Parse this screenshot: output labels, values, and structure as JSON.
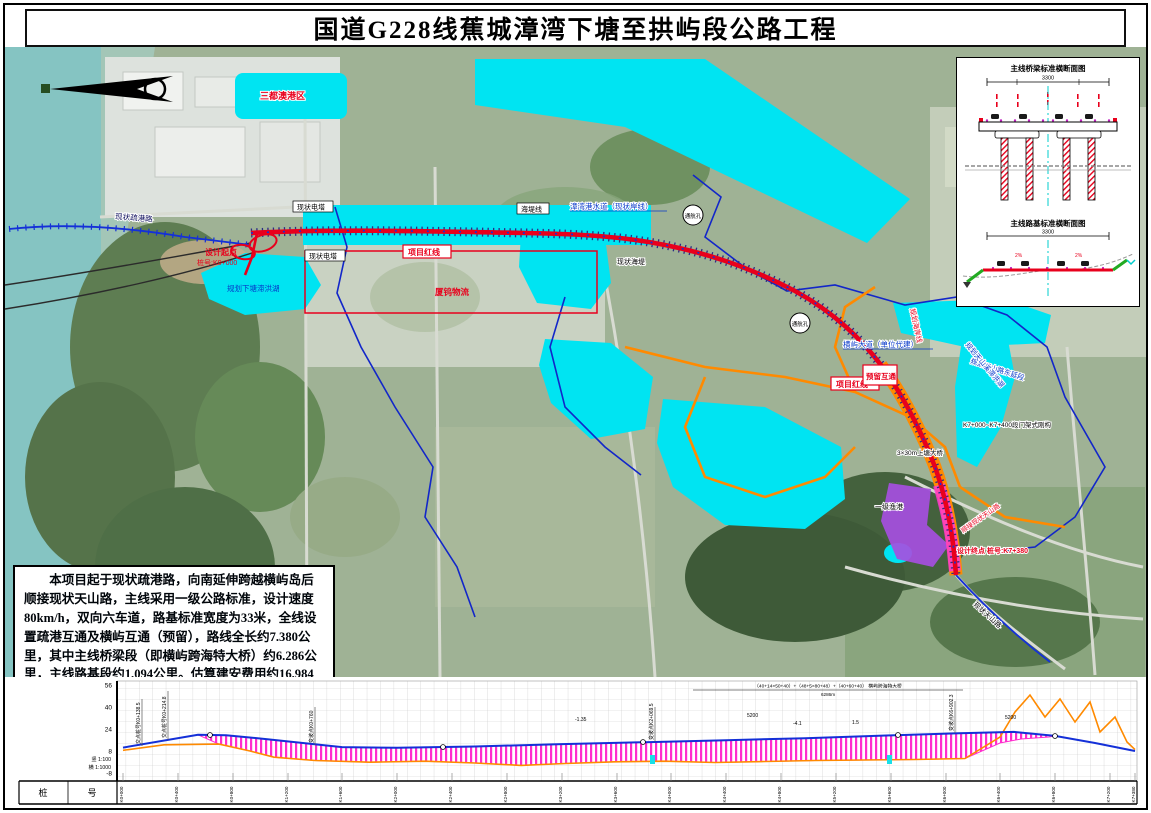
{
  "title": "国道G228线蕉城漳湾下塘至拱屿段公路工程",
  "description": "本项目起于现状疏港路，向南延伸跨越横屿岛后顺接现状天山路，主线采用一级公路标准，设计速度80km/h，双向六车道，路基标准宽度为33米，全线设置疏港互通及横屿互通（预留），路线全长约7.380公里，其中主线桥梁段（即横屿跨海特大桥）约6.286公里，主线路基段约1.094公里。估算建安费用约16.984亿元，总投资约20.931亿元。",
  "colors": {
    "route_red": "#e8001c",
    "planned_water_cyan": "#00e4f2",
    "planned_road_orange": "#ff8a00",
    "boundary_blue": "#1226c9",
    "profile_fill_magenta": "#ff22cc",
    "design_line_blue": "#1430d8",
    "ground_line_orange": "#ff8a00",
    "reserved_land_purple": "#a64fe0"
  },
  "inset": {
    "bridge_section_title": "主线桥梁标准横断面图",
    "bridge_width_dim": "3300",
    "roadbed_section_title": "主线路基标准横断面图",
    "roadbed_width_dim": "3300",
    "grade_left": "2%",
    "grade_right": "2%"
  },
  "map": {
    "labels": {
      "port_area": "三都澳港区",
      "shugang_road": "现状疏港路",
      "start_label": "设计起点",
      "start_station": "桩号:K0+000",
      "lake_xiatang": "规划下塘滞洪湖",
      "logistics": "厦钨物流",
      "tower1": "现状电塔",
      "tower2": "现状电塔",
      "seawall_line": "海堤线",
      "redline1": "项目红线",
      "channel": "漳湾港水道（现状岸线）",
      "nav1": "通航孔",
      "nav2": "通航孔",
      "seawall": "现状海堤",
      "hengyu_ave": "横屿大道（单位代建）",
      "redline2": "项目红线",
      "reserved_ic": "预留互通",
      "coast_line": "规划海岸线",
      "tianshan_ext": "规划天山路东延段",
      "lake_tianshan": "规划天山溪滞洪湖",
      "rigid_frame": "K7+000~K7+400段门架式刚构",
      "shangtang_bridge": "3×30m上塘大桥",
      "fishing_port": "一级渔港",
      "end_connect": "顺接现状天山路",
      "end_label": "设计终点 桩号:K7+380",
      "tianshan_road": "现状天山路"
    }
  },
  "profile": {
    "scale_v": "竖 1:100",
    "scale_h": "横 1:1000",
    "row_cells": [
      "桩",
      "号"
    ],
    "bridge_note": "（40+14×50+40）+（48+5×80+48）+（40+60+40） 横屿跨海特大桥",
    "bridge_len": "6286m",
    "yticks": [
      "56",
      "40",
      "24",
      "8",
      "-8"
    ],
    "grades": [
      "-1.35",
      "5200",
      "-4.1",
      "1.5",
      "5200"
    ],
    "callouts": [
      "交点桩号K0+138.5",
      "交点桩号K0+214.8",
      "变坡点K0+760",
      "变坡点K2+069.5",
      "变坡点K6+902.3"
    ]
  },
  "chart_data": {
    "type": "line",
    "title": "路线纵断面图",
    "xlabel": "桩号",
    "ylabel": "标高(m)",
    "ylim": [
      -8,
      56
    ],
    "grid": true,
    "legend_position": "none",
    "stations": [
      "K0+000",
      "K0+400",
      "K0+800",
      "K1+200",
      "K1+600",
      "K2+000",
      "K2+400",
      "K2+800",
      "K3+200",
      "K3+600",
      "K4+000",
      "K4+400",
      "K4+800",
      "K5+200",
      "K5+600",
      "K6+000",
      "K6+400",
      "K6+800",
      "K7+200",
      "K7+380"
    ],
    "series": [
      {
        "name": "设计线",
        "color": "#1430d8",
        "values": [
          10.5,
          19.5,
          15.0,
          11.5,
          10.8,
          11.0,
          11.8,
          12.5,
          13.2,
          14.0,
          15.0,
          16.0,
          17.0,
          18.2,
          19.2,
          20.3,
          21.5,
          19.0,
          13.0,
          8.0
        ]
      },
      {
        "name": "地面线",
        "color": "#ff8a00",
        "values": [
          8.5,
          12.5,
          5.0,
          2.0,
          0.5,
          0.0,
          1.0,
          -1.5,
          0.0,
          0.5,
          1.0,
          0.5,
          1.5,
          2.0,
          2.5,
          3.0,
          5.0,
          26.0,
          36.0,
          9.0
        ]
      }
    ]
  }
}
